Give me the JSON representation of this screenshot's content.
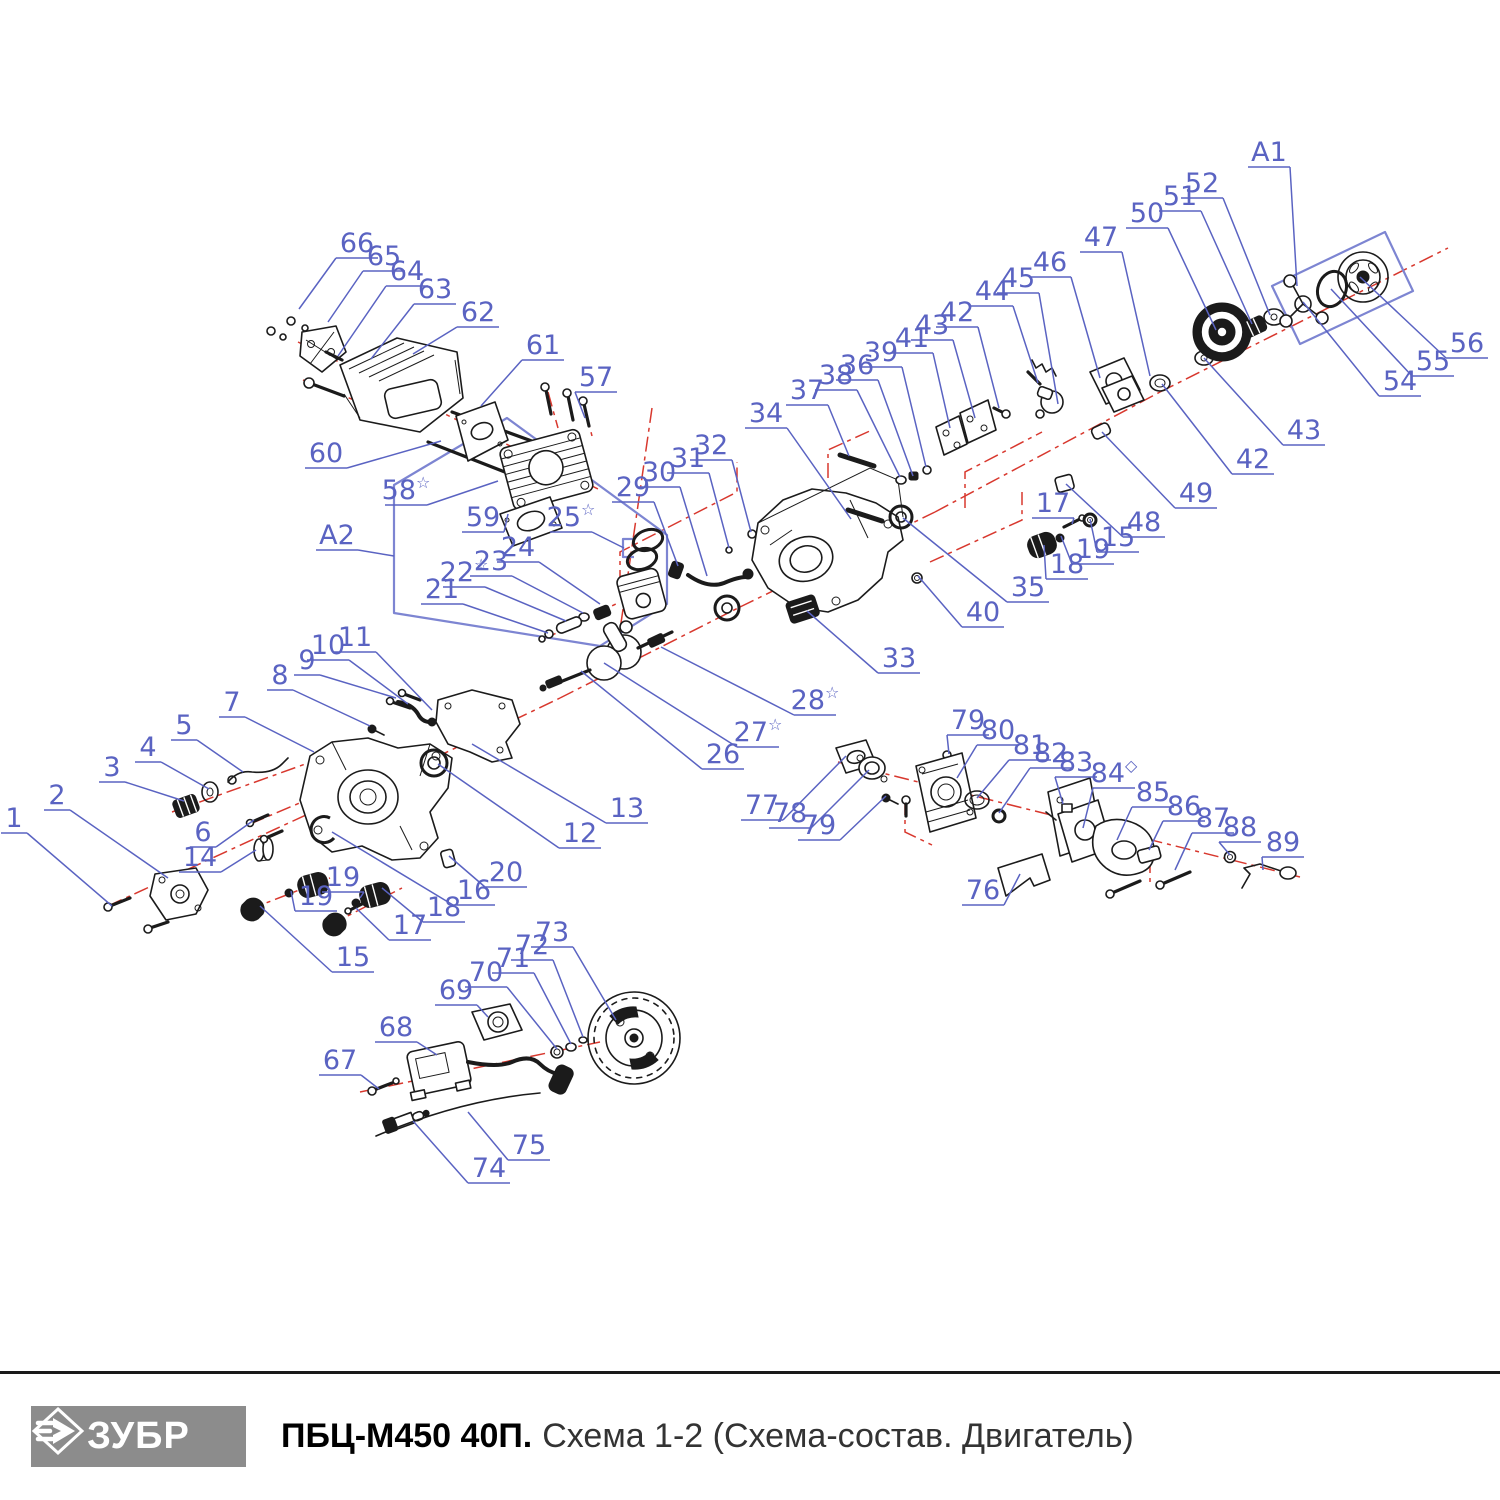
{
  "doc": {
    "type": "exploded-parts-diagram",
    "assembly_refs": [
      "A1",
      "A2"
    ]
  },
  "colors": {
    "callout_blue": "#5a63c2",
    "box_blue": "#7d85d2",
    "centerline_red": "#d8382e",
    "ink": "#1b1b1b",
    "logo_gray": "#8c8c8c"
  },
  "footer": {
    "brand": "ЗУБР",
    "model": "ПБЦ-М450 40П.",
    "subtitle": "Схема 1-2 (Схема-состав. Двигатель)"
  },
  "callouts": [
    {
      "t": "1",
      "x": 14,
      "y": 818,
      "ex": 112,
      "ey": 906
    },
    {
      "t": "2",
      "x": 57,
      "y": 795,
      "ex": 168,
      "ey": 878
    },
    {
      "t": "3",
      "x": 112,
      "y": 767,
      "ex": 184,
      "ey": 801
    },
    {
      "t": "4",
      "x": 148,
      "y": 747,
      "ex": 209,
      "ey": 789
    },
    {
      "t": "5",
      "x": 184,
      "y": 725,
      "ex": 243,
      "ey": 772
    },
    {
      "t": "6",
      "x": 203,
      "y": 832,
      "ex": 254,
      "ey": 820
    },
    {
      "t": "7",
      "x": 232,
      "y": 702,
      "ex": 314,
      "ey": 752
    },
    {
      "t": "8",
      "x": 280,
      "y": 675,
      "ex": 370,
      "ey": 726
    },
    {
      "t": "9",
      "x": 307,
      "y": 660,
      "ex": 396,
      "ey": 698
    },
    {
      "t": "10",
      "x": 328,
      "y": 645,
      "ex": 408,
      "ey": 704
    },
    {
      "t": "11",
      "x": 355,
      "y": 637,
      "ex": 432,
      "ey": 710
    },
    {
      "t": "12",
      "x": 580,
      "y": 833,
      "ex": 438,
      "ey": 764
    },
    {
      "t": "13",
      "x": 627,
      "y": 808,
      "ex": 472,
      "ey": 744
    },
    {
      "t": "14",
      "x": 200,
      "y": 857,
      "ex": 256,
      "ey": 850
    },
    {
      "t": "15",
      "x": 353,
      "y": 957,
      "ex": 260,
      "ey": 906
    },
    {
      "t": "16",
      "x": 474,
      "y": 890,
      "ex": 332,
      "ey": 832
    },
    {
      "t": "17",
      "x": 410,
      "y": 925,
      "ex": 356,
      "ey": 908
    },
    {
      "t": "18",
      "x": 444,
      "y": 907,
      "ex": 382,
      "ey": 888
    },
    {
      "t": "19",
      "x": 316,
      "y": 896,
      "ex": 291,
      "ey": 891
    },
    {
      "t": "19",
      "x": 343,
      "y": 877,
      "ex": 360,
      "ey": 898
    },
    {
      "t": "20",
      "x": 506,
      "y": 872,
      "ex": 449,
      "ey": 856
    },
    {
      "t": "21",
      "x": 442,
      "y": 589,
      "ex": 548,
      "ey": 633
    },
    {
      "t": "22",
      "s": "☆",
      "x": 464,
      "y": 572,
      "ex": 566,
      "ey": 621
    },
    {
      "t": "23",
      "x": 491,
      "y": 561,
      "ex": 583,
      "ey": 613
    },
    {
      "t": "24",
      "x": 518,
      "y": 547,
      "ex": 600,
      "ey": 604
    },
    {
      "t": "25",
      "s": "☆",
      "x": 571,
      "y": 517,
      "ex": 624,
      "ey": 548
    },
    {
      "t": "26",
      "x": 723,
      "y": 754,
      "ex": 581,
      "ey": 671
    },
    {
      "t": "27",
      "s": "☆",
      "x": 758,
      "y": 732,
      "ex": 604,
      "ey": 663
    },
    {
      "t": "28",
      "s": "☆",
      "x": 815,
      "y": 700,
      "ex": 661,
      "ey": 647
    },
    {
      "t": "29",
      "x": 633,
      "y": 487,
      "ex": 678,
      "ey": 566
    },
    {
      "t": "30",
      "x": 659,
      "y": 472,
      "ex": 707,
      "ey": 576
    },
    {
      "t": "31",
      "x": 688,
      "y": 458,
      "ex": 729,
      "ey": 548
    },
    {
      "t": "32",
      "x": 711,
      "y": 445,
      "ex": 751,
      "ey": 532
    },
    {
      "t": "33",
      "x": 899,
      "y": 658,
      "ex": 807,
      "ey": 611
    },
    {
      "t": "34",
      "x": 766,
      "y": 413,
      "ex": 851,
      "ey": 519
    },
    {
      "t": "35",
      "x": 1028,
      "y": 587,
      "ex": 903,
      "ey": 518
    },
    {
      "t": "36",
      "x": 857,
      "y": 365,
      "ex": 913,
      "ey": 476
    },
    {
      "t": "37",
      "x": 807,
      "y": 390,
      "ex": 849,
      "ey": 456
    },
    {
      "t": "38",
      "x": 836,
      "y": 375,
      "ex": 900,
      "ey": 477
    },
    {
      "t": "39",
      "x": 881,
      "y": 352,
      "ex": 926,
      "ey": 467
    },
    {
      "t": "40",
      "x": 983,
      "y": 612,
      "ex": 918,
      "ey": 576
    },
    {
      "t": "41",
      "x": 912,
      "y": 338,
      "ex": 950,
      "ey": 428
    },
    {
      "t": "42",
      "x": 957,
      "y": 312,
      "ex": 999,
      "ey": 408
    },
    {
      "t": "43",
      "x": 932,
      "y": 325,
      "ex": 975,
      "ey": 418
    },
    {
      "t": "44",
      "x": 992,
      "y": 291,
      "ex": 1038,
      "ey": 383
    },
    {
      "t": "45",
      "x": 1018,
      "y": 278,
      "ex": 1058,
      "ey": 404
    },
    {
      "t": "46",
      "x": 1050,
      "y": 262,
      "ex": 1100,
      "ey": 378
    },
    {
      "t": "47",
      "x": 1101,
      "y": 237,
      "ex": 1150,
      "ey": 376
    },
    {
      "t": "48",
      "x": 1144,
      "y": 522,
      "ex": 1066,
      "ey": 484
    },
    {
      "t": "49",
      "x": 1196,
      "y": 493,
      "ex": 1102,
      "ey": 432
    },
    {
      "t": "50",
      "x": 1147,
      "y": 213,
      "ex": 1216,
      "ey": 330
    },
    {
      "t": "51",
      "x": 1180,
      "y": 196,
      "ex": 1252,
      "ey": 324
    },
    {
      "t": "52",
      "x": 1202,
      "y": 183,
      "ex": 1270,
      "ey": 315
    },
    {
      "t": "15",
      "x": 1118,
      "y": 537,
      "ex": 1090,
      "ey": 519
    },
    {
      "t": "17",
      "x": 1053,
      "y": 503,
      "ex": 1072,
      "ey": 524
    },
    {
      "t": "18",
      "x": 1067,
      "y": 564,
      "ex": 1044,
      "ey": 545
    },
    {
      "t": "19",
      "x": 1093,
      "y": 549,
      "ex": 1061,
      "ey": 536
    },
    {
      "t": "42",
      "x": 1253,
      "y": 459,
      "ex": 1162,
      "ey": 384
    },
    {
      "t": "43",
      "x": 1304,
      "y": 430,
      "ex": 1204,
      "ey": 358
    },
    {
      "t": "54",
      "x": 1400,
      "y": 381,
      "ex": 1303,
      "ey": 302
    },
    {
      "t": "55",
      "x": 1433,
      "y": 361,
      "ex": 1331,
      "ey": 289
    },
    {
      "t": "56",
      "x": 1467,
      "y": 343,
      "ex": 1360,
      "ey": 277
    },
    {
      "t": "57",
      "x": 596,
      "y": 377,
      "ex": 585,
      "ey": 418
    },
    {
      "t": "58",
      "s": "☆",
      "x": 406,
      "y": 490,
      "ex": 498,
      "ey": 481
    },
    {
      "t": "59",
      "x": 483,
      "y": 517,
      "ex": 508,
      "ey": 514
    },
    {
      "t": "60",
      "x": 326,
      "y": 453,
      "ex": 441,
      "ey": 441
    },
    {
      "t": "61",
      "x": 543,
      "y": 345,
      "ex": 481,
      "ey": 406
    },
    {
      "t": "62",
      "x": 478,
      "y": 312,
      "ex": 413,
      "ey": 354
    },
    {
      "t": "63",
      "x": 435,
      "y": 289,
      "ex": 371,
      "ey": 359
    },
    {
      "t": "64",
      "x": 407,
      "y": 271,
      "ex": 338,
      "ey": 356
    },
    {
      "t": "65",
      "x": 384,
      "y": 256,
      "ex": 328,
      "ey": 322
    },
    {
      "t": "66",
      "x": 357,
      "y": 243,
      "ex": 299,
      "ey": 309
    },
    {
      "t": "67",
      "x": 340,
      "y": 1060,
      "ex": 379,
      "ey": 1089
    },
    {
      "t": "68",
      "x": 396,
      "y": 1027,
      "ex": 437,
      "ey": 1055
    },
    {
      "t": "69",
      "x": 456,
      "y": 990,
      "ex": 488,
      "ey": 1017
    },
    {
      "t": "70",
      "x": 486,
      "y": 972,
      "ex": 557,
      "ey": 1049
    },
    {
      "t": "71",
      "x": 513,
      "y": 958,
      "ex": 571,
      "ey": 1044
    },
    {
      "t": "72",
      "x": 532,
      "y": 945,
      "ex": 583,
      "ey": 1037
    },
    {
      "t": "73",
      "x": 552,
      "y": 932,
      "ex": 616,
      "ey": 1020
    },
    {
      "t": "74",
      "x": 489,
      "y": 1168,
      "ex": 413,
      "ey": 1121
    },
    {
      "t": "75",
      "x": 529,
      "y": 1145,
      "ex": 468,
      "ey": 1112
    },
    {
      "t": "76",
      "x": 983,
      "y": 890,
      "ex": 1020,
      "ey": 874
    },
    {
      "t": "77",
      "x": 762,
      "y": 805,
      "ex": 846,
      "ey": 756
    },
    {
      "t": "78",
      "x": 790,
      "y": 813,
      "ex": 869,
      "ey": 770
    },
    {
      "t": "79",
      "x": 819,
      "y": 825,
      "ex": 886,
      "ey": 796
    },
    {
      "t": "79",
      "x": 968,
      "y": 720,
      "ex": 949,
      "ey": 754
    },
    {
      "t": "80",
      "x": 998,
      "y": 730,
      "ex": 957,
      "ey": 778
    },
    {
      "t": "81",
      "x": 1030,
      "y": 745,
      "ex": 977,
      "ey": 798
    },
    {
      "t": "82",
      "x": 1051,
      "y": 753,
      "ex": 999,
      "ey": 813
    },
    {
      "t": "83",
      "x": 1076,
      "y": 762,
      "ex": 1063,
      "ey": 804
    },
    {
      "t": "84",
      "s": "◇",
      "x": 1114,
      "y": 773,
      "ex": 1083,
      "ey": 828
    },
    {
      "t": "85",
      "x": 1153,
      "y": 792,
      "ex": 1117,
      "ey": 840
    },
    {
      "t": "86",
      "x": 1184,
      "y": 806,
      "ex": 1149,
      "ey": 850
    },
    {
      "t": "87",
      "x": 1213,
      "y": 818,
      "ex": 1175,
      "ey": 870
    },
    {
      "t": "88",
      "x": 1240,
      "y": 827,
      "ex": 1230,
      "ey": 855
    },
    {
      "t": "89",
      "x": 1283,
      "y": 842,
      "ex": 1263,
      "ey": 870
    },
    {
      "t": "A1",
      "x": 1269,
      "y": 152,
      "ex": 1297,
      "ey": 286
    },
    {
      "t": "A2",
      "x": 337,
      "y": 535,
      "ex": 394,
      "ey": 556
    }
  ]
}
